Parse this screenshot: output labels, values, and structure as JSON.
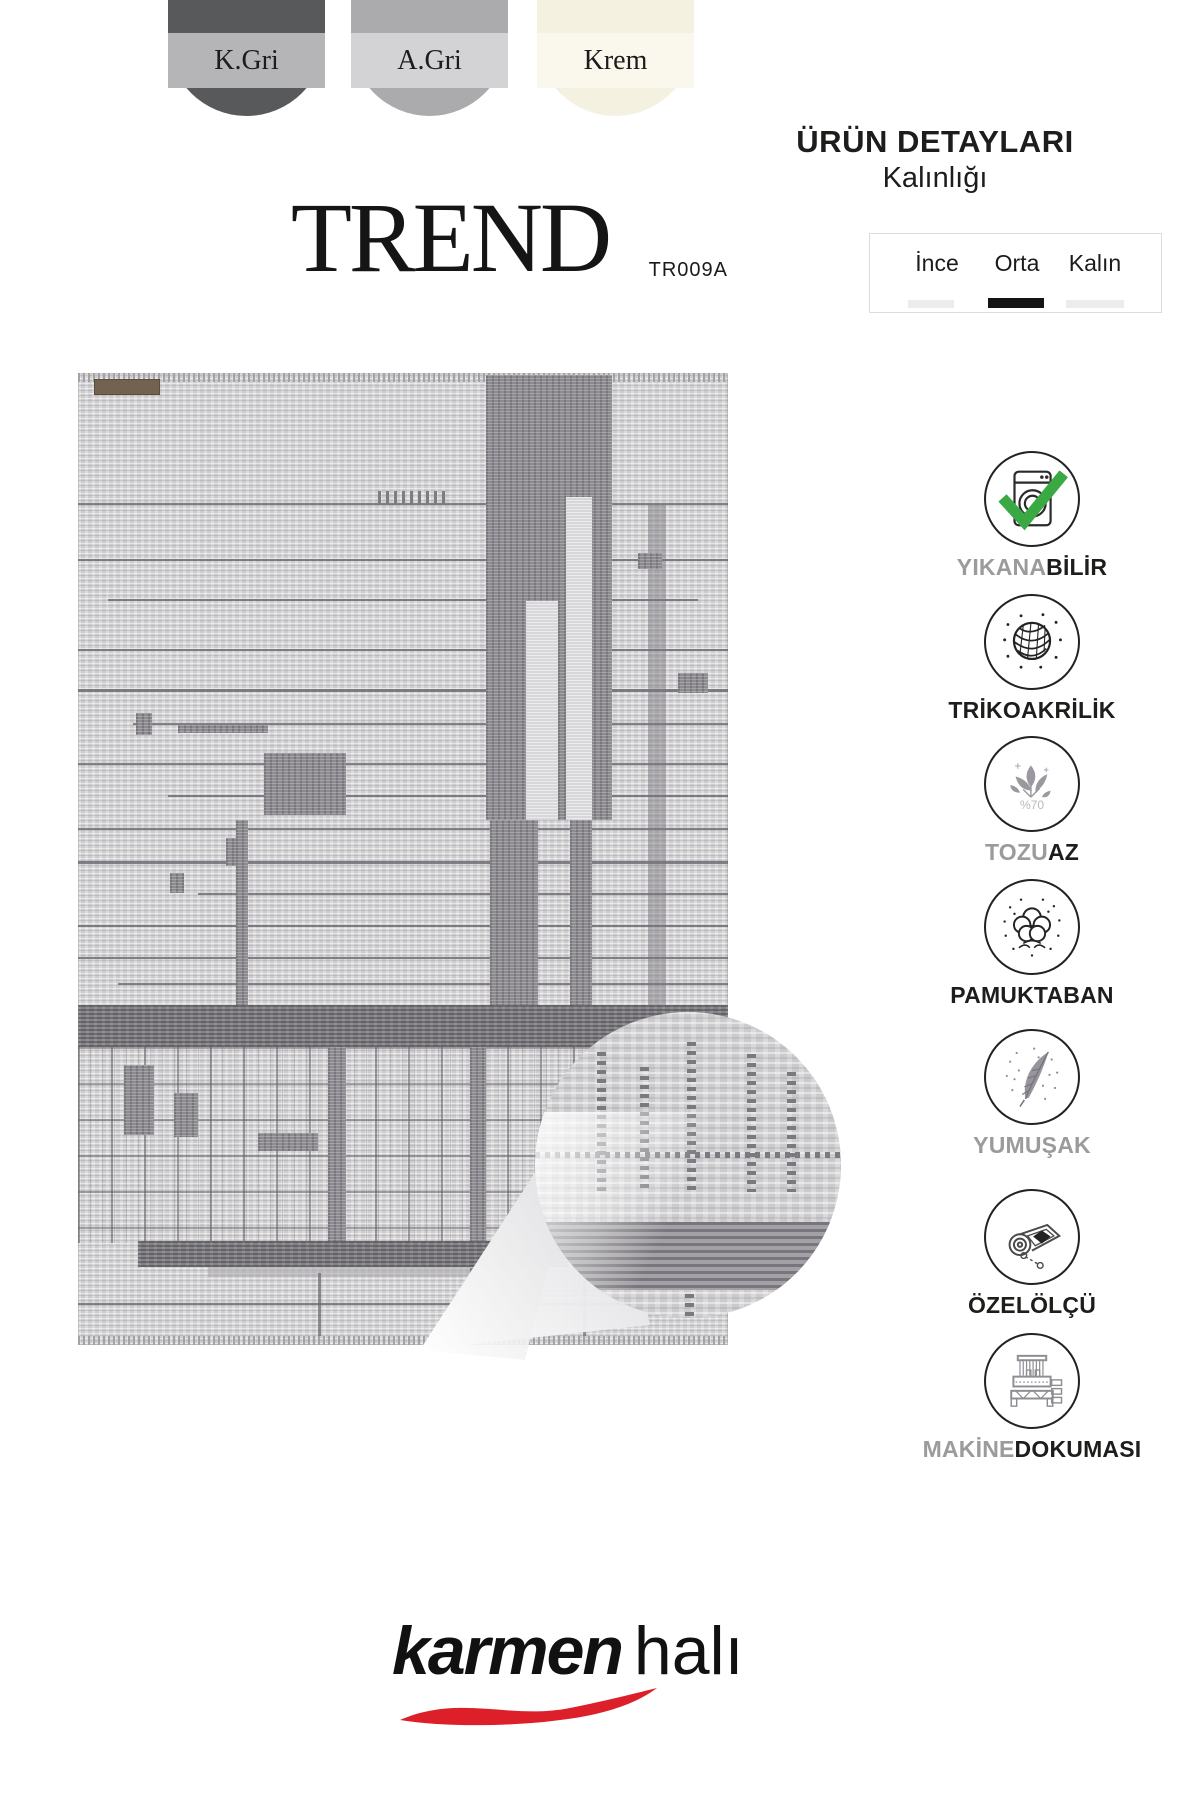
{
  "swatches": [
    {
      "label": "K.Gri",
      "base": "#58595b",
      "band": "#b5b5b7"
    },
    {
      "label": "A.Gri",
      "base": "#ababad",
      "band": "#d3d3d5"
    },
    {
      "label": "Krem",
      "base": "#f4f1e1",
      "band": "#faf8ec"
    }
  ],
  "title": {
    "name": "TREND",
    "code": "TR009A"
  },
  "details": {
    "heading": "ÜRÜN DETAYLARI",
    "subheading": "Kalınlığı",
    "options": [
      {
        "label": "İnce",
        "selected": false
      },
      {
        "label": "Orta",
        "selected": true
      },
      {
        "label": "Kalın",
        "selected": false
      }
    ]
  },
  "features": [
    {
      "icon": "washing-machine",
      "gray": "YIKANA",
      "black": "BİLİR"
    },
    {
      "icon": "yarn-ball",
      "gray": "",
      "black": "TRİKOAKRİLİK"
    },
    {
      "icon": "leaves",
      "gray": "TOZU",
      "black": "AZ",
      "note": "%70"
    },
    {
      "icon": "cotton",
      "gray": "",
      "black": "PAMUKTABAN"
    },
    {
      "icon": "feather",
      "gray": "YUMUŞAK",
      "black": ""
    },
    {
      "icon": "rolled-rug",
      "gray": "",
      "black": "ÖZELÖLÇÜ"
    },
    {
      "icon": "loom",
      "gray": "MAKİNE",
      "black": "DOKUMASI"
    }
  ],
  "brand": {
    "bold": "karmen",
    "light": "halı"
  },
  "colors": {
    "check_green": "#3aa943",
    "swoosh_red": "#dc1f28",
    "label_gray": "#9b9b9b",
    "text_black": "#1d1d1b",
    "rug_base": "#d6d5d7",
    "rug_dark": "#8d8b90"
  }
}
